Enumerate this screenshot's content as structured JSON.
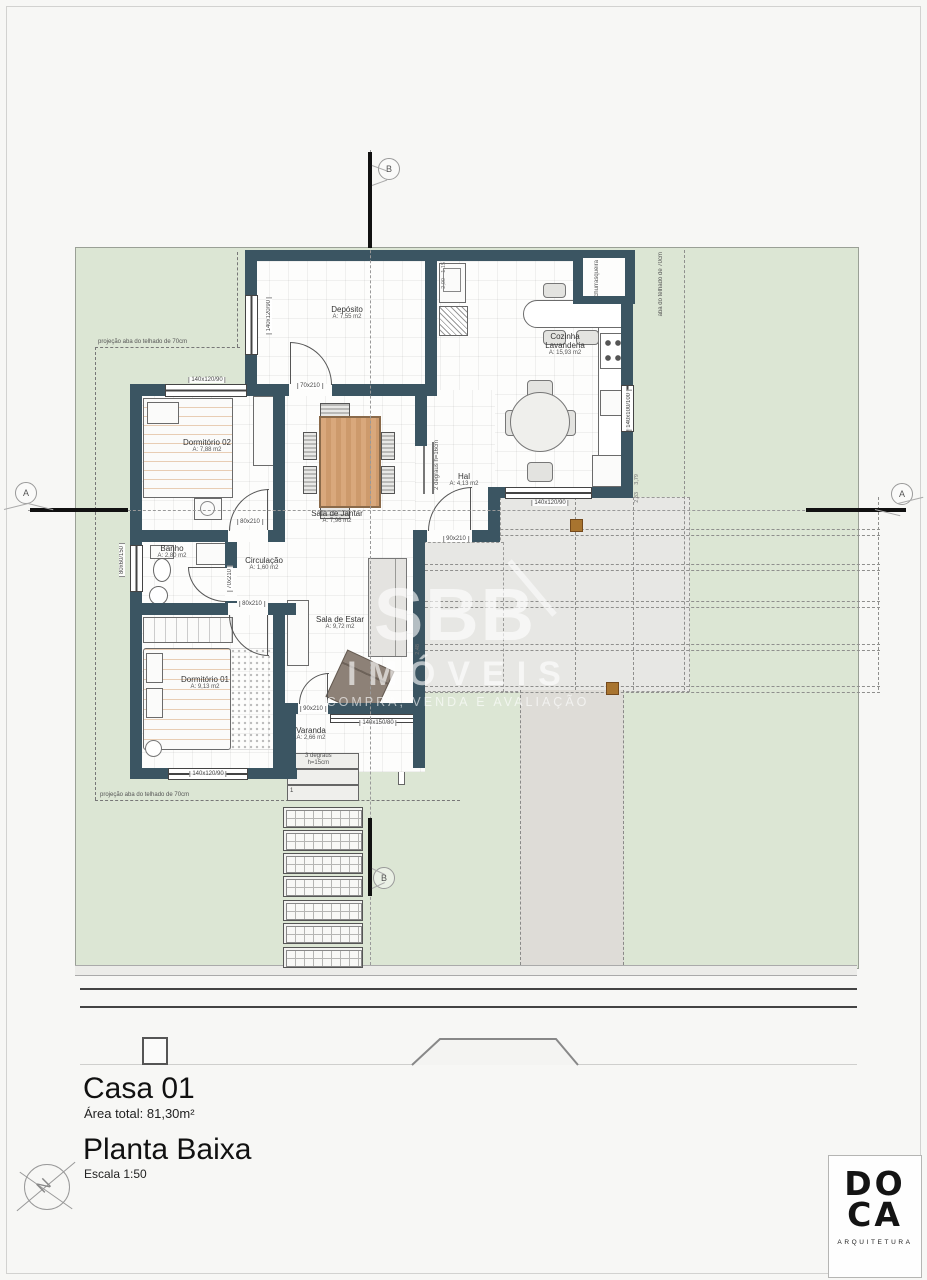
{
  "title_block": {
    "title": "Casa 01",
    "area_total": "Área total: 81,30m²",
    "drawing": "Planta Baixa",
    "scale": "Escala 1:50"
  },
  "logo": {
    "line1": "DO",
    "line2": "CA",
    "subtitle": "ARQUITETURA"
  },
  "compass": {
    "label": "N"
  },
  "watermark": {
    "brand": "SBB",
    "line2": "IMÓVEIS",
    "line3": "COMPRA, VENDA E AVALIAÇÃO"
  },
  "sections": {
    "a": "A",
    "b": "B"
  },
  "rooms": [
    {
      "name": "Depósito",
      "area": "A: 7,55 m2"
    },
    {
      "name": "Cozinha",
      "name2": "Lavanderia",
      "area": "A: 15,93 m2"
    },
    {
      "name": "Hal",
      "area": "A: 4,13 m2"
    },
    {
      "name": "Sala de Jantar",
      "area": "A: 7,96 m2"
    },
    {
      "name": "Dormitório 02",
      "area": "A: 7,88 m2"
    },
    {
      "name": "Banho",
      "area": "A: 2,80 m2"
    },
    {
      "name": "Circulação",
      "area": "A: 1,60 m2"
    },
    {
      "name": "Sala de Estar",
      "area": "A: 9,72 m2"
    },
    {
      "name": "Dormitório 01",
      "area": "A: 9,13 m2"
    },
    {
      "name": "Varanda",
      "area": "A: 2,66 m2"
    }
  ],
  "openings": {
    "dep_window_w": "140x120/90",
    "dep_door": "70x210",
    "dorm2_window": "140x120/90",
    "dorm2_door": "80x210",
    "banho_door": "70x210",
    "banho_window": "80x60/150",
    "dorm1_door": "80x210",
    "dorm1_window": "140x120/90",
    "hal_door": "90x210",
    "kitchen_window_s": "140x120/90",
    "kitchen_window_e": "140x100/100",
    "varanda_door": "90x210",
    "varanda_rail": "140x150/80"
  },
  "annotations": {
    "roof_left_top": "projeção aba do telhado de 70cm",
    "roof_left_bottom": "projeção aba do telhado de 70cm",
    "roof_right": "aba do telhado de 70cm",
    "churrasqueira": "churrasqueira",
    "steps_hal_1": "2 degraus",
    "steps_hal_2": "h=16cm",
    "steps_var_1": "3  degraus",
    "steps_var_2": "h=15cm",
    "step3": "3",
    "step2": "2",
    "step1": "1"
  },
  "dims": {
    "d1": "1,15",
    "d2": "2,00",
    "d3": "3,79",
    "d4": "2,83",
    "d5": "2,48"
  },
  "colors": {
    "wall": "#3b5562",
    "site_green": "#dce6d4",
    "patio_gray": "#e7e7e4",
    "wood": "#d9a87c",
    "post_brown": "#a8742f"
  }
}
